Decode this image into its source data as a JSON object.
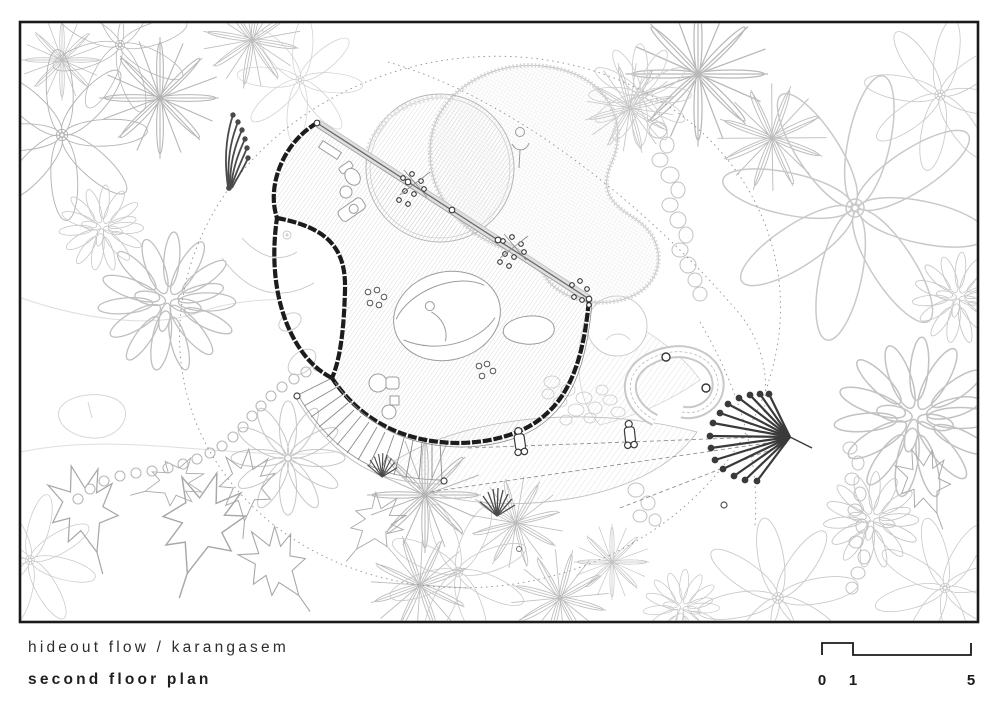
{
  "titleblock": {
    "project_name": "hideout flow / karangasem",
    "drawing_name": "second floor plan"
  },
  "scale_bar": {
    "start_label": "0",
    "mid_label": "1",
    "end_label": "5"
  },
  "palette": {
    "paper": "#ffffff",
    "frame": "#1a1a1a",
    "wall_ink": "#1c1c1c",
    "glass_wall": "#6a6a6a",
    "furniture": "#9c9c9c",
    "vegetation_light": "#c6c6c6",
    "vegetation_dark": "#3a3a3a",
    "deck_hatch": "#bdbdbd",
    "guide_dash": "#909090",
    "text": "#2e2e2e"
  }
}
